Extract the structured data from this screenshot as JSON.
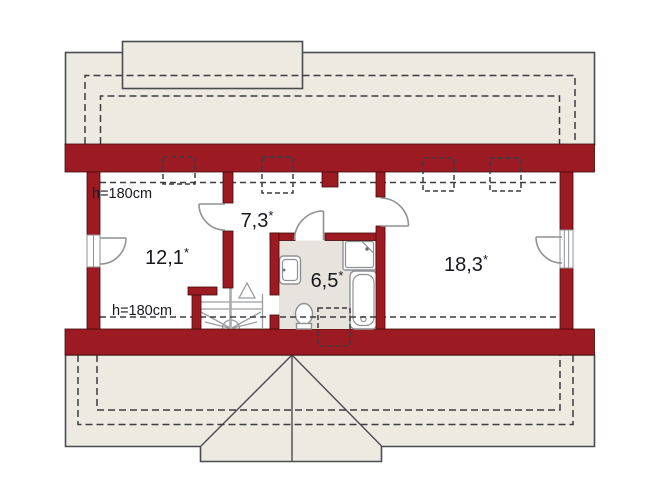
{
  "plan": {
    "type": "floor-plan-attic",
    "rooms": [
      {
        "id": "room-left",
        "area": "12,1",
        "mark": "*"
      },
      {
        "id": "room-hall",
        "area": "7,3",
        "mark": "*"
      },
      {
        "id": "room-bath",
        "area": "6,5",
        "mark": "*"
      },
      {
        "id": "room-right",
        "area": "18,3",
        "mark": "*"
      }
    ],
    "height_labels": {
      "top": "h=180cm",
      "bottom": "h=180cm"
    },
    "colors": {
      "wall": "#9c1b22",
      "wall_edge": "#42090c",
      "roof": "#edeae2",
      "roof_line": "#4b4c4f",
      "bath_floor": "#e7e4dd",
      "dash": "#3c3d41",
      "fixture": "#8f9194",
      "text": "#17171f"
    }
  }
}
